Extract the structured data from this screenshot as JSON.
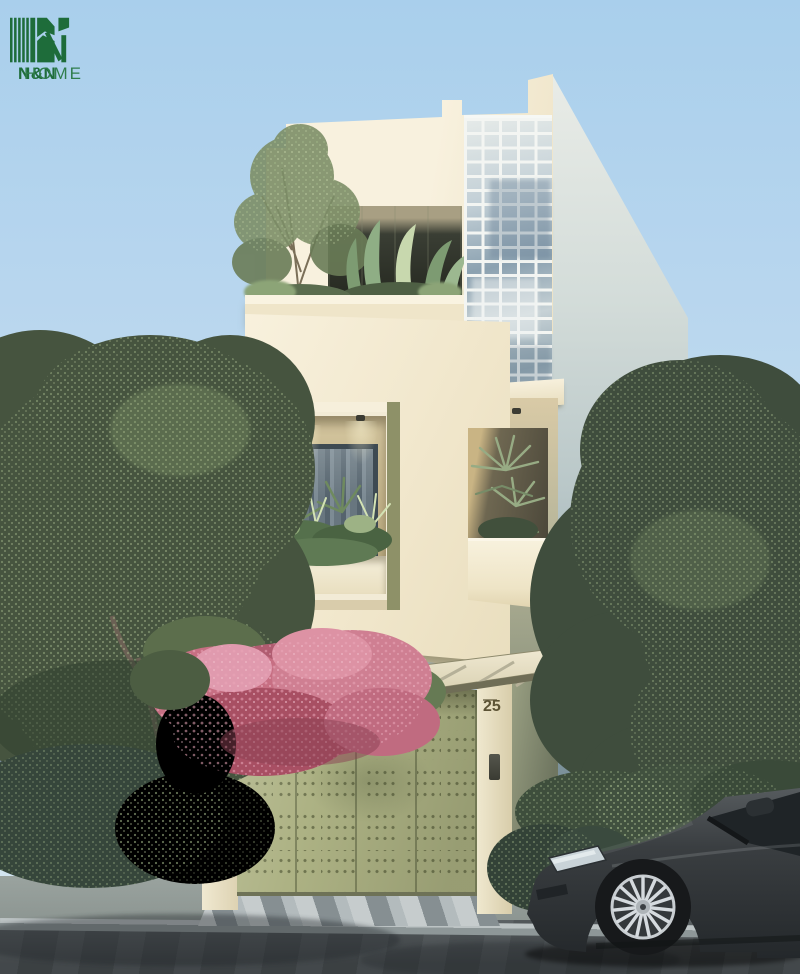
{
  "logo": {
    "brand": "N&N",
    "suffix": "HOME"
  },
  "house": {
    "number": "25"
  },
  "palette": {
    "sky_top": "#a9cfec",
    "sky_mid": "#c3dcef",
    "sky_bottom": "#d6e6f0",
    "facade": "#f2ebd6",
    "ledge": "#efe5c9",
    "soffit": "#a89f83",
    "glass_line": "#f3f5f2",
    "glass_deep": "#8ba1b0",
    "window_frame": "#3e4a52",
    "curtain_a": "#55636d",
    "curtain_b": "#7d8b94",
    "gate": "#adb284",
    "gate_divider": "#7f855f",
    "number_color": "#5c5335",
    "canopy": "#ece5cc",
    "foliage_dark": "#46543f",
    "foliage_mid": "#5d7252",
    "foliage_light": "#93a77d",
    "flower": "#c06d81",
    "flower_dark": "#a14f63",
    "flower_light": "#e09db0",
    "hedge": "#36463b",
    "road": "#4c5255",
    "sidewalk": "#8b9490",
    "curb": "#bcc3c4",
    "ramp_light": "#c6cccd",
    "ramp_dark": "#868f92",
    "sidewall_top": "#e9ece7",
    "sidewall_low": "#84999f",
    "car_body": "#3a3e41",
    "car_glass": "#1f2427",
    "rim": "#ccd1d4",
    "neighbor": "#4a5861",
    "neighbor_band": "#cfd4cf",
    "logo_green": "#1e6c3a",
    "logo_green2": "#2f7d4c"
  }
}
